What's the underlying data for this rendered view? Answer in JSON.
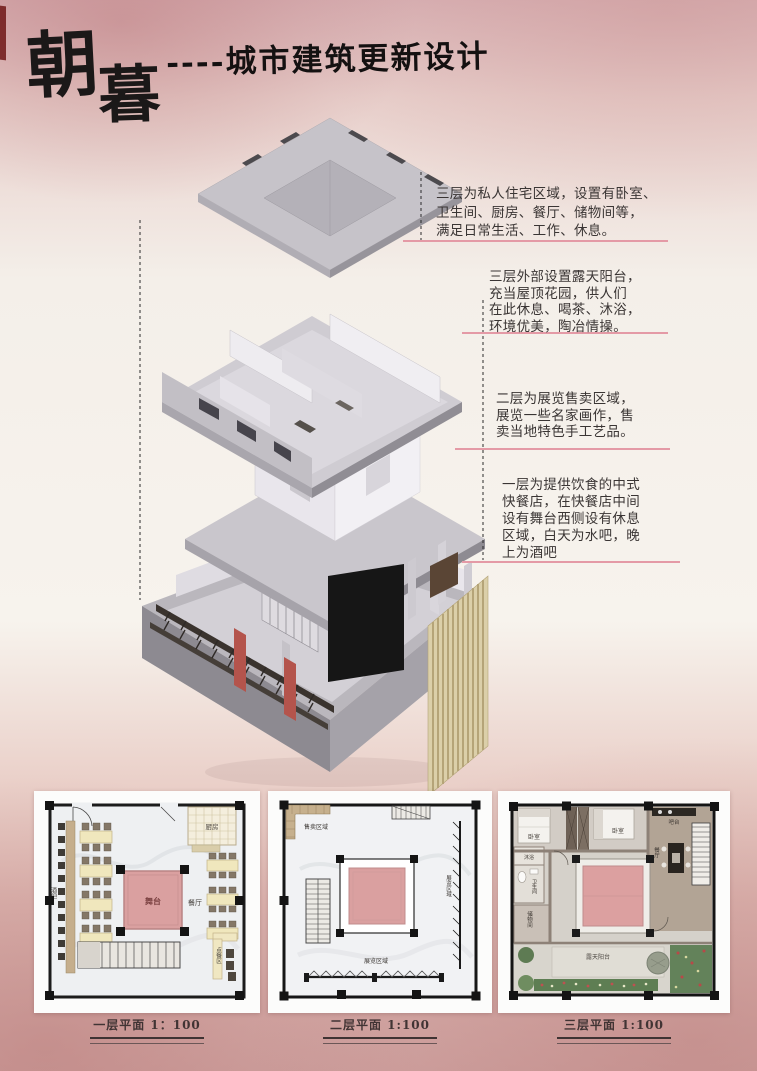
{
  "poster": {
    "title": {
      "char_top": "朝",
      "char_bottom": "暮",
      "subtitle": "----城市建筑更新设计"
    },
    "colors": {
      "bg_top": "#d8b1b4",
      "bg_mid": "#f6f1eb",
      "bg_bottom": "#cfa3a1",
      "accent_line": "#e49aa6",
      "stage_pink": "#dca0a0",
      "building_gray": "#c6c3c9",
      "red_column": "#b4544c",
      "ink": "#1b1818"
    }
  },
  "annotations": [
    {
      "lines": [
        "三层为私人住宅区域，设置有卧室、",
        "卫生间、厨房、餐厅、储物间等，",
        "满足日常生活、工作、休息。"
      ]
    },
    {
      "lines": [
        "三层外部设置露天阳台，",
        "充当屋顶花园，供人们",
        "在此休息、喝茶、沐浴，",
        "环境优美，陶冶情操。"
      ]
    },
    {
      "lines": [
        "二层为展览售卖区域，",
        "展览一些名家画作，售",
        "卖当地特色手工艺品。"
      ]
    },
    {
      "lines": [
        "一层为提供饮食的中式",
        "快餐店，在快餐店中间",
        "设有舞台西侧设有休息",
        "区域，白天为水吧，晚",
        "上为酒吧"
      ]
    }
  ],
  "plans": [
    {
      "caption": "一层平面 1：100",
      "labels": {
        "kitchen": "厨房",
        "stage": "舞台",
        "dining": "餐厅",
        "bar": "酒吧",
        "order": "点餐区"
      }
    },
    {
      "caption": "二层平面 1:100",
      "labels": {
        "sale": "售卖区域",
        "exhibit_bottom": "展览区域",
        "exhibit_right": "展览区域"
      }
    },
    {
      "caption": "三层平面 1:100",
      "labels": {
        "bedroom1": "卧室",
        "bedroom2": "卧室",
        "bath": "沐浴",
        "toilet": "卫生间",
        "storage": "储物间",
        "barcounter": "吧台",
        "dining": "餐厅",
        "terrace": "露天阳台"
      }
    }
  ]
}
